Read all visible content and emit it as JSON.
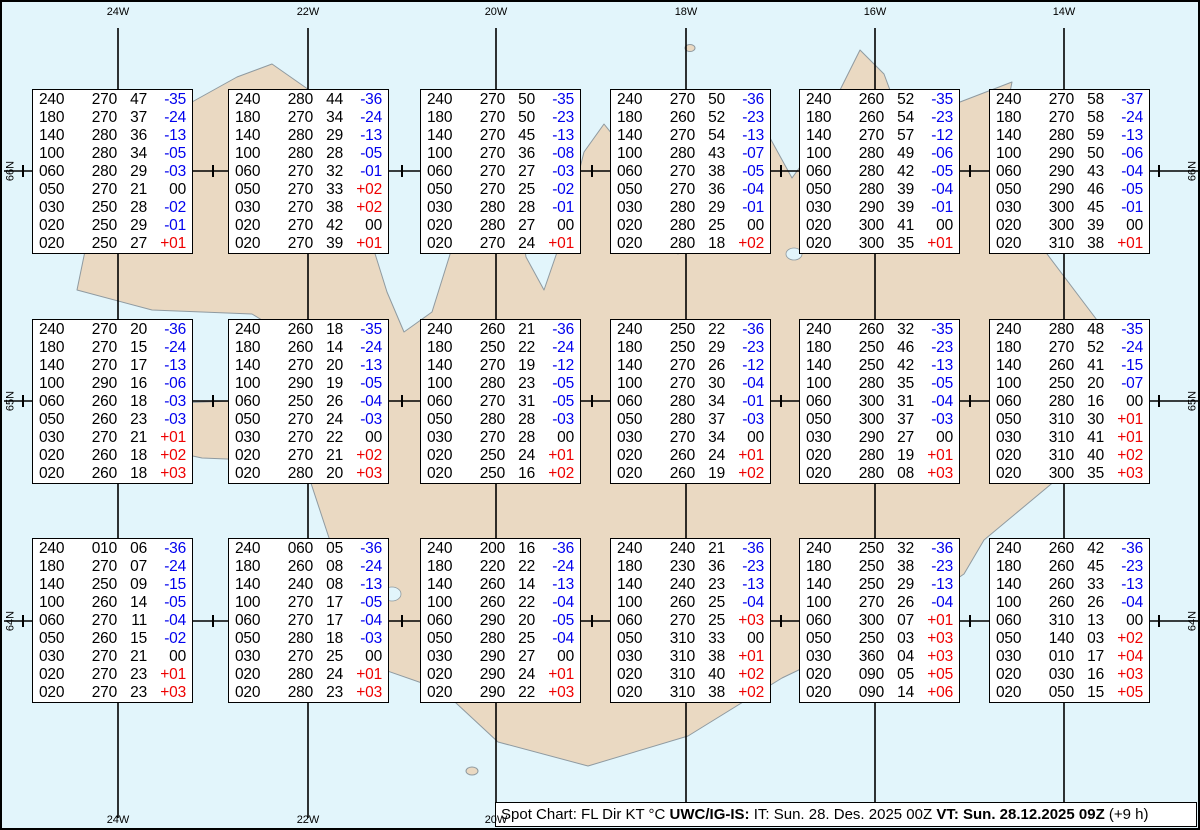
{
  "page_title": "Spot Chart",
  "map": {
    "sea_color": "#e2f5fb",
    "land_color": "#ead9c2",
    "coast_color": "#8f9aa0",
    "top_longitude_labels": [
      "24W",
      "22W",
      "20W",
      "18W",
      "16W",
      "14W"
    ],
    "bottom_longitude_labels": [
      "24W",
      "22W",
      "20W"
    ],
    "left_latitude_labels": [
      "66N",
      "65N",
      "64N"
    ],
    "right_latitude_labels": [
      "66N",
      "65N",
      "64N"
    ]
  },
  "legend": {
    "parts": [
      {
        "text": "Spot Chart: FL Dir KT °C ",
        "bold": false
      },
      {
        "text": "UWC/IG-IS:",
        "bold": true
      },
      {
        "text": " IT: Sun. 28. Des. 2025 00Z ",
        "bold": false
      },
      {
        "text": "VT: Sun. 28.12.2025 09Z",
        "bold": true
      },
      {
        "text": " (+9 h)",
        "bold": false
      }
    ]
  },
  "chart_data": {
    "type": "table",
    "title": "Spot Chart: FL Dir KT °C",
    "columns": [
      "FL",
      "Dir",
      "KT",
      "°C"
    ],
    "issue_time_label": "IT: Sun. 28. Des. 2025 00Z",
    "valid_time_label": "VT: Sun. 28.12.2025 09Z (+9 h)",
    "grid_longitudes": [
      "24W",
      "22W",
      "20W",
      "18W",
      "16W",
      "14W"
    ],
    "grid_latitudes": [
      "66N",
      "65N",
      "64N"
    ],
    "temp_negative_color": "#0000ee",
    "temp_positive_color": "#ee0000",
    "spots": [
      {
        "rows": [
          [
            "240",
            "270",
            "47",
            "-35"
          ],
          [
            "180",
            "270",
            "37",
            "-24"
          ],
          [
            "140",
            "280",
            "36",
            "-13"
          ],
          [
            "100",
            "280",
            "34",
            "-05"
          ],
          [
            "060",
            "280",
            "29",
            "-03"
          ],
          [
            "050",
            "270",
            "21",
            "00"
          ],
          [
            "030",
            "250",
            "28",
            "-02"
          ],
          [
            "020",
            "250",
            "29",
            "-01"
          ],
          [
            "020",
            "250",
            "27",
            "+01"
          ]
        ]
      },
      {
        "rows": [
          [
            "240",
            "280",
            "44",
            "-36"
          ],
          [
            "180",
            "270",
            "34",
            "-24"
          ],
          [
            "140",
            "280",
            "29",
            "-13"
          ],
          [
            "100",
            "280",
            "28",
            "-05"
          ],
          [
            "060",
            "270",
            "32",
            "-01"
          ],
          [
            "050",
            "270",
            "33",
            "+02"
          ],
          [
            "030",
            "270",
            "38",
            "+02"
          ],
          [
            "020",
            "270",
            "42",
            "00"
          ],
          [
            "020",
            "270",
            "39",
            "+01"
          ]
        ]
      },
      {
        "rows": [
          [
            "240",
            "270",
            "50",
            "-35"
          ],
          [
            "180",
            "270",
            "50",
            "-23"
          ],
          [
            "140",
            "270",
            "45",
            "-13"
          ],
          [
            "100",
            "270",
            "36",
            "-08"
          ],
          [
            "060",
            "270",
            "27",
            "-03"
          ],
          [
            "050",
            "270",
            "25",
            "-02"
          ],
          [
            "030",
            "280",
            "28",
            "-01"
          ],
          [
            "020",
            "280",
            "27",
            "00"
          ],
          [
            "020",
            "270",
            "24",
            "+01"
          ]
        ]
      },
      {
        "rows": [
          [
            "240",
            "270",
            "50",
            "-36"
          ],
          [
            "180",
            "260",
            "52",
            "-23"
          ],
          [
            "140",
            "270",
            "54",
            "-13"
          ],
          [
            "100",
            "280",
            "43",
            "-07"
          ],
          [
            "060",
            "270",
            "38",
            "-05"
          ],
          [
            "050",
            "270",
            "36",
            "-04"
          ],
          [
            "030",
            "280",
            "29",
            "-01"
          ],
          [
            "020",
            "280",
            "25",
            "00"
          ],
          [
            "020",
            "280",
            "18",
            "+02"
          ]
        ]
      },
      {
        "rows": [
          [
            "240",
            "260",
            "52",
            "-35"
          ],
          [
            "180",
            "260",
            "54",
            "-23"
          ],
          [
            "140",
            "270",
            "57",
            "-12"
          ],
          [
            "100",
            "280",
            "49",
            "-06"
          ],
          [
            "060",
            "280",
            "42",
            "-05"
          ],
          [
            "050",
            "280",
            "39",
            "-04"
          ],
          [
            "030",
            "290",
            "39",
            "-01"
          ],
          [
            "020",
            "300",
            "41",
            "00"
          ],
          [
            "020",
            "300",
            "35",
            "+01"
          ]
        ]
      },
      {
        "rows": [
          [
            "240",
            "270",
            "58",
            "-37"
          ],
          [
            "180",
            "270",
            "58",
            "-24"
          ],
          [
            "140",
            "280",
            "59",
            "-13"
          ],
          [
            "100",
            "290",
            "50",
            "-06"
          ],
          [
            "060",
            "290",
            "43",
            "-04"
          ],
          [
            "050",
            "290",
            "46",
            "-05"
          ],
          [
            "030",
            "300",
            "45",
            "-01"
          ],
          [
            "020",
            "300",
            "39",
            "00"
          ],
          [
            "020",
            "310",
            "38",
            "+01"
          ]
        ]
      },
      {
        "rows": [
          [
            "240",
            "270",
            "20",
            "-36"
          ],
          [
            "180",
            "270",
            "15",
            "-24"
          ],
          [
            "140",
            "270",
            "17",
            "-13"
          ],
          [
            "100",
            "290",
            "16",
            "-06"
          ],
          [
            "060",
            "260",
            "18",
            "-03"
          ],
          [
            "050",
            "260",
            "23",
            "-03"
          ],
          [
            "030",
            "270",
            "21",
            "+01"
          ],
          [
            "020",
            "260",
            "18",
            "+02"
          ],
          [
            "020",
            "260",
            "18",
            "+03"
          ]
        ]
      },
      {
        "rows": [
          [
            "240",
            "260",
            "18",
            "-35"
          ],
          [
            "180",
            "260",
            "14",
            "-24"
          ],
          [
            "140",
            "270",
            "20",
            "-13"
          ],
          [
            "100",
            "290",
            "19",
            "-05"
          ],
          [
            "060",
            "250",
            "26",
            "-04"
          ],
          [
            "050",
            "270",
            "24",
            "-03"
          ],
          [
            "030",
            "270",
            "22",
            "00"
          ],
          [
            "020",
            "270",
            "21",
            "+02"
          ],
          [
            "020",
            "280",
            "20",
            "+03"
          ]
        ]
      },
      {
        "rows": [
          [
            "240",
            "260",
            "21",
            "-36"
          ],
          [
            "180",
            "250",
            "22",
            "-24"
          ],
          [
            "140",
            "270",
            "19",
            "-12"
          ],
          [
            "100",
            "280",
            "23",
            "-05"
          ],
          [
            "060",
            "270",
            "31",
            "-05"
          ],
          [
            "050",
            "280",
            "28",
            "-03"
          ],
          [
            "030",
            "270",
            "28",
            "00"
          ],
          [
            "020",
            "250",
            "24",
            "+01"
          ],
          [
            "020",
            "250",
            "16",
            "+02"
          ]
        ]
      },
      {
        "rows": [
          [
            "240",
            "250",
            "22",
            "-36"
          ],
          [
            "180",
            "250",
            "29",
            "-23"
          ],
          [
            "140",
            "270",
            "26",
            "-12"
          ],
          [
            "100",
            "270",
            "30",
            "-04"
          ],
          [
            "060",
            "280",
            "34",
            "-01"
          ],
          [
            "050",
            "280",
            "37",
            "-03"
          ],
          [
            "030",
            "270",
            "34",
            "00"
          ],
          [
            "020",
            "260",
            "24",
            "+01"
          ],
          [
            "020",
            "260",
            "19",
            "+02"
          ]
        ]
      },
      {
        "rows": [
          [
            "240",
            "260",
            "32",
            "-35"
          ],
          [
            "180",
            "250",
            "46",
            "-23"
          ],
          [
            "140",
            "250",
            "42",
            "-13"
          ],
          [
            "100",
            "280",
            "35",
            "-05"
          ],
          [
            "060",
            "300",
            "31",
            "-04"
          ],
          [
            "050",
            "300",
            "37",
            "-03"
          ],
          [
            "030",
            "290",
            "27",
            "00"
          ],
          [
            "020",
            "280",
            "19",
            "+01"
          ],
          [
            "020",
            "280",
            "08",
            "+03"
          ]
        ]
      },
      {
        "rows": [
          [
            "240",
            "280",
            "48",
            "-35"
          ],
          [
            "180",
            "270",
            "52",
            "-24"
          ],
          [
            "140",
            "260",
            "41",
            "-15"
          ],
          [
            "100",
            "250",
            "20",
            "-07"
          ],
          [
            "060",
            "280",
            "16",
            "00"
          ],
          [
            "050",
            "310",
            "30",
            "+01"
          ],
          [
            "030",
            "310",
            "41",
            "+01"
          ],
          [
            "020",
            "310",
            "40",
            "+02"
          ],
          [
            "020",
            "300",
            "35",
            "+03"
          ]
        ]
      },
      {
        "rows": [
          [
            "240",
            "010",
            "06",
            "-36"
          ],
          [
            "180",
            "270",
            "07",
            "-24"
          ],
          [
            "140",
            "250",
            "09",
            "-15"
          ],
          [
            "100",
            "260",
            "14",
            "-05"
          ],
          [
            "060",
            "270",
            "11",
            "-04"
          ],
          [
            "050",
            "260",
            "15",
            "-02"
          ],
          [
            "030",
            "270",
            "21",
            "00"
          ],
          [
            "020",
            "270",
            "23",
            "+01"
          ],
          [
            "020",
            "270",
            "23",
            "+03"
          ]
        ]
      },
      {
        "rows": [
          [
            "240",
            "060",
            "05",
            "-36"
          ],
          [
            "180",
            "260",
            "08",
            "-24"
          ],
          [
            "140",
            "240",
            "08",
            "-13"
          ],
          [
            "100",
            "270",
            "17",
            "-05"
          ],
          [
            "060",
            "270",
            "17",
            "-04"
          ],
          [
            "050",
            "280",
            "18",
            "-03"
          ],
          [
            "030",
            "270",
            "25",
            "00"
          ],
          [
            "020",
            "280",
            "24",
            "+01"
          ],
          [
            "020",
            "280",
            "23",
            "+03"
          ]
        ]
      },
      {
        "rows": [
          [
            "240",
            "200",
            "16",
            "-36"
          ],
          [
            "180",
            "220",
            "22",
            "-24"
          ],
          [
            "140",
            "260",
            "14",
            "-13"
          ],
          [
            "100",
            "260",
            "22",
            "-04"
          ],
          [
            "060",
            "290",
            "20",
            "-05"
          ],
          [
            "050",
            "280",
            "25",
            "-04"
          ],
          [
            "030",
            "290",
            "27",
            "00"
          ],
          [
            "020",
            "290",
            "24",
            "+01"
          ],
          [
            "020",
            "290",
            "22",
            "+03"
          ]
        ]
      },
      {
        "rows": [
          [
            "240",
            "240",
            "21",
            "-36"
          ],
          [
            "180",
            "230",
            "36",
            "-23"
          ],
          [
            "140",
            "240",
            "23",
            "-13"
          ],
          [
            "100",
            "260",
            "25",
            "-04"
          ],
          [
            "060",
            "270",
            "25",
            "+03"
          ],
          [
            "050",
            "310",
            "33",
            "00"
          ],
          [
            "030",
            "310",
            "38",
            "+01"
          ],
          [
            "020",
            "310",
            "40",
            "+02"
          ],
          [
            "020",
            "310",
            "38",
            "+02"
          ]
        ]
      },
      {
        "rows": [
          [
            "240",
            "250",
            "32",
            "-36"
          ],
          [
            "180",
            "250",
            "38",
            "-23"
          ],
          [
            "140",
            "250",
            "29",
            "-13"
          ],
          [
            "100",
            "270",
            "26",
            "-04"
          ],
          [
            "060",
            "300",
            "07",
            "+01"
          ],
          [
            "050",
            "250",
            "03",
            "+03"
          ],
          [
            "030",
            "360",
            "04",
            "+03"
          ],
          [
            "020",
            "090",
            "05",
            "+05"
          ],
          [
            "020",
            "090",
            "14",
            "+06"
          ]
        ]
      },
      {
        "rows": [
          [
            "240",
            "260",
            "42",
            "-36"
          ],
          [
            "180",
            "260",
            "45",
            "-23"
          ],
          [
            "140",
            "260",
            "33",
            "-13"
          ],
          [
            "100",
            "260",
            "26",
            "-04"
          ],
          [
            "060",
            "310",
            "13",
            "00"
          ],
          [
            "050",
            "140",
            "03",
            "+02"
          ],
          [
            "030",
            "010",
            "17",
            "+04"
          ],
          [
            "020",
            "030",
            "16",
            "+03"
          ],
          [
            "020",
            "050",
            "15",
            "+05"
          ]
        ]
      }
    ]
  }
}
